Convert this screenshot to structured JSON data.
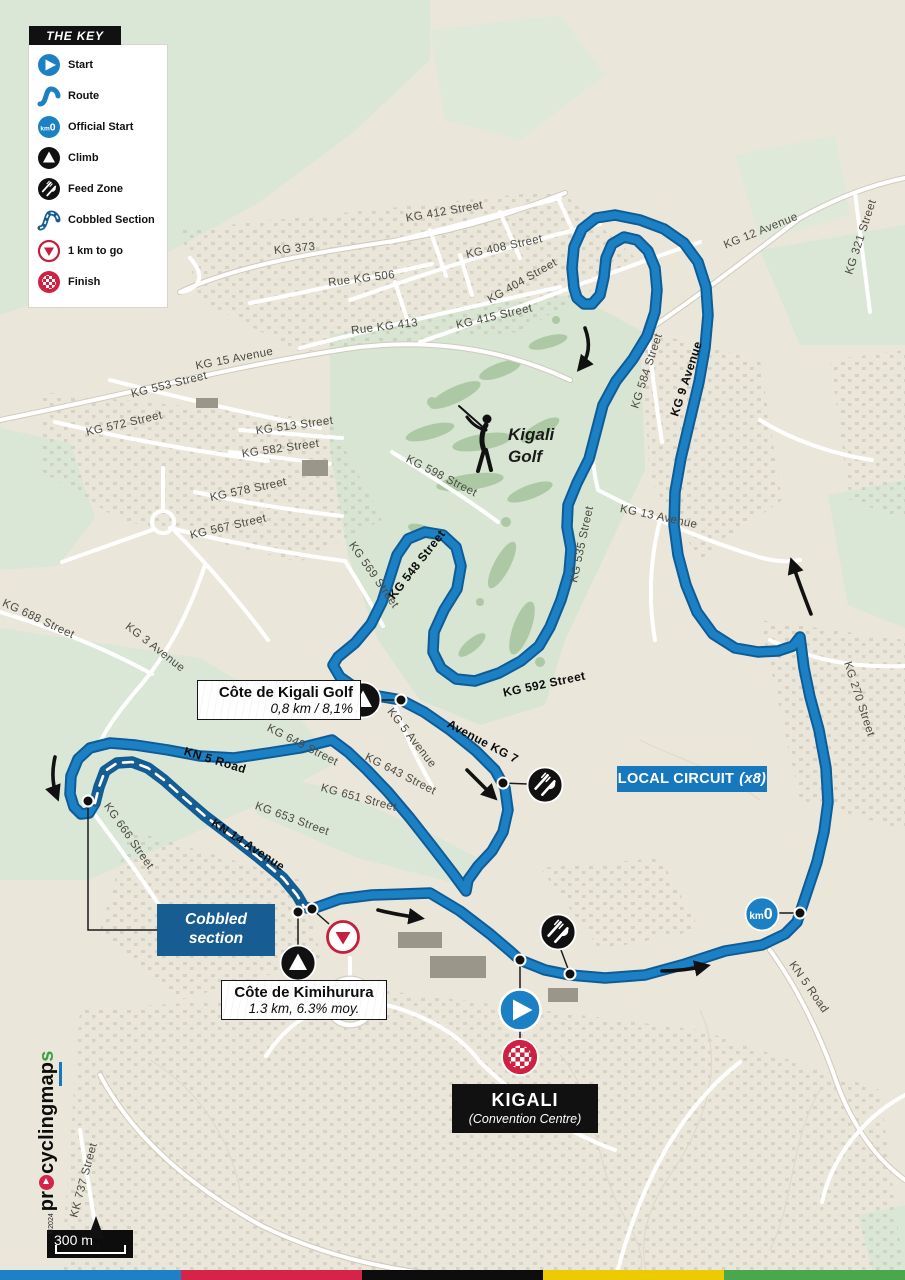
{
  "legend": {
    "title": "THE KEY",
    "items": [
      {
        "icon": "start-icon",
        "label": "Start"
      },
      {
        "icon": "route-icon",
        "label": "Route"
      },
      {
        "icon": "km0-icon",
        "label": "Official Start"
      },
      {
        "icon": "climb-icon",
        "label": "Climb"
      },
      {
        "icon": "feed-zone-icon",
        "label": "Feed Zone"
      },
      {
        "icon": "cobbled-icon",
        "label": "Cobbled Section"
      },
      {
        "icon": "one-km-icon",
        "label": "1 km to go"
      },
      {
        "icon": "finish-icon",
        "label": "Finish"
      }
    ]
  },
  "streets": [
    "KG 412 Street",
    "KG 373",
    "KG 408 Street",
    "Rue KG 506",
    "KG 404 Street",
    "KG 415 Street",
    "Rue KG 413",
    "KG 15 Avenue",
    "KG 553 Street",
    "KG 572 Street",
    "KG 513 Street",
    "KG 582 Street",
    "KG 578 Street",
    "KG 567 Street",
    "KG 569 Street",
    "KG 598 Street",
    "KG 548 Street",
    "KG 535 Street",
    "KG 13 Avenue",
    "KG 584 Street",
    "KG 9 Avenue",
    "KG 12 Avenue",
    "KG 321 Street",
    "KG 270 Street",
    "KG 592 Street",
    "KG 688 Street",
    "KG 3 Avenue",
    "KG 666 Street",
    "KN 5 Road",
    "KN 14 Avenue",
    "KG 649 Street",
    "KG 643 Street",
    "KG 651 Street",
    "KG 653 Street",
    "KG 5 Avenue",
    "Avenue KG 7",
    "KN 5 Road",
    "KK 737 Street"
  ],
  "labels": {
    "golf": {
      "line1": "Kigali",
      "line2": "Golf"
    },
    "cote_golf": {
      "title": "Côte de Kigali Golf",
      "subtitle": "0,8 km / 8,1%"
    },
    "local_circuit": {
      "title": "LOCAL CIRCUIT",
      "reps": "(x8)"
    },
    "cobbled": {
      "line1": "Cobbled",
      "line2": "section"
    },
    "kimihurura": {
      "title": "Côte de Kimihurura",
      "subtitle": "1.3 km, 6.3% moy."
    },
    "kigali": {
      "title": "KIGALI",
      "subtitle": "(Convention Centre)"
    },
    "km0": {
      "km": "km",
      "zero": "0"
    }
  },
  "scale": {
    "label": "300 m"
  },
  "north": {
    "label": "N"
  },
  "logo": {
    "copyright": "©2024",
    "part1": "pr",
    "part2": "cyclingm",
    "part3": "ap",
    "part4": "s"
  },
  "colors": {
    "route_blue": "#1c80c4",
    "route_casing": "#0e5c95",
    "circuit_box_blue": "#1878bd",
    "cobbled_box_blue": "#175d92",
    "finish_red": "#d02142",
    "one_km_red": "#c41f3e",
    "map_background": "#eae6da",
    "golf_green": "#d7e5d2",
    "bottom_bar": [
      "#1e80c6",
      "#d52349",
      "#0d0d0d",
      "#eccb00",
      "#4aa74c"
    ]
  }
}
